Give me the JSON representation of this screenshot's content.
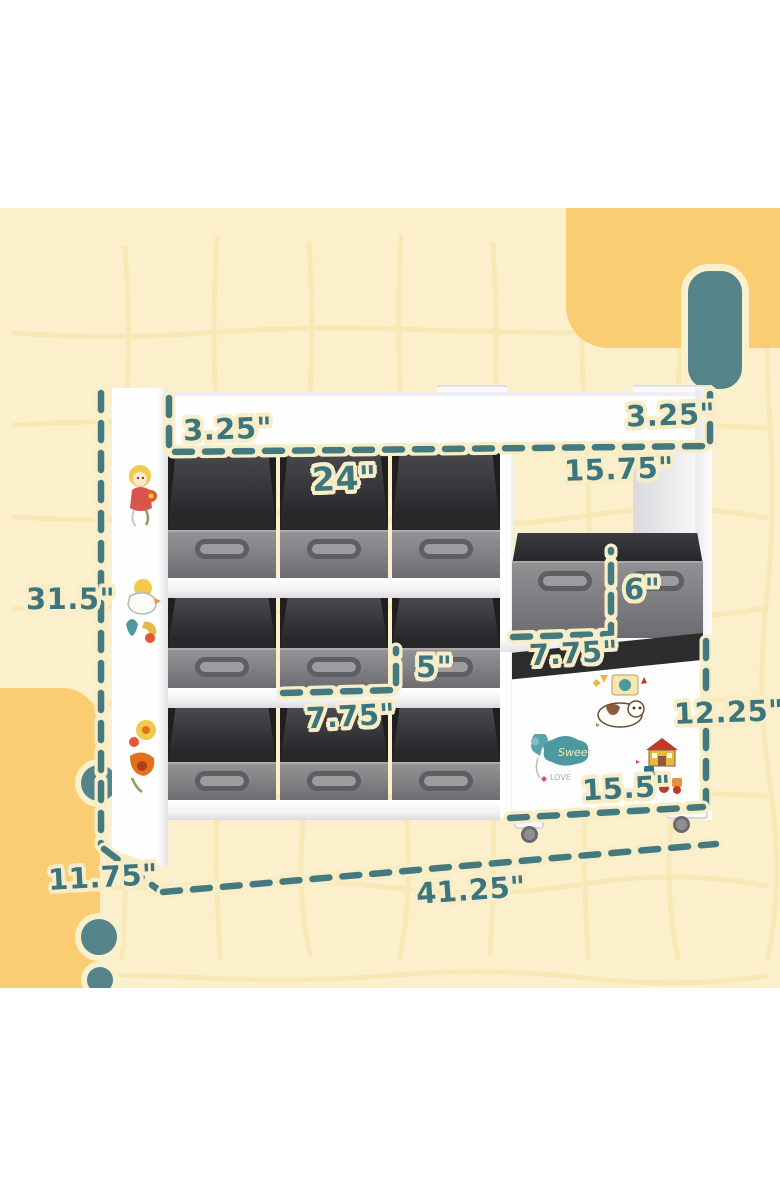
{
  "canvas": {
    "width": 780,
    "height": 1196
  },
  "dimensions": {
    "top_left_board_thickness": "3.25\"",
    "top_right_board_thickness": "3.25\"",
    "left_section_width": "24\"",
    "right_cubby_width": "15.75\"",
    "overall_height": "31.5\"",
    "right_bin_height": "6\"",
    "left_bin_height": "5\"",
    "left_bin_depth": "7.75\"",
    "right_bin_depth": "7.75\"",
    "right_cabinet_height": "12.25\"",
    "right_cabinet_width": "15.5\"",
    "overall_depth": "11.75\"",
    "overall_width": "41.25\""
  },
  "stickers": {
    "cloud_text": "Sweet",
    "love_text": "LOVE"
  },
  "furniture": {
    "left_bin_rows": 3,
    "left_bins_per_row": 3,
    "right_wide_bins": 1,
    "casters": 2
  },
  "colors": {
    "background": "#FBF0CB",
    "accent_yellow": "#FACD72",
    "accent_teal": "#55838A",
    "dash_teal": "#44797F",
    "label_teal": "#3B757D",
    "label_outline": "#F8EDC6",
    "bin_front": "#7C7C7F",
    "bin_interior": "#313134",
    "furniture_white": "#FDFDFE"
  }
}
